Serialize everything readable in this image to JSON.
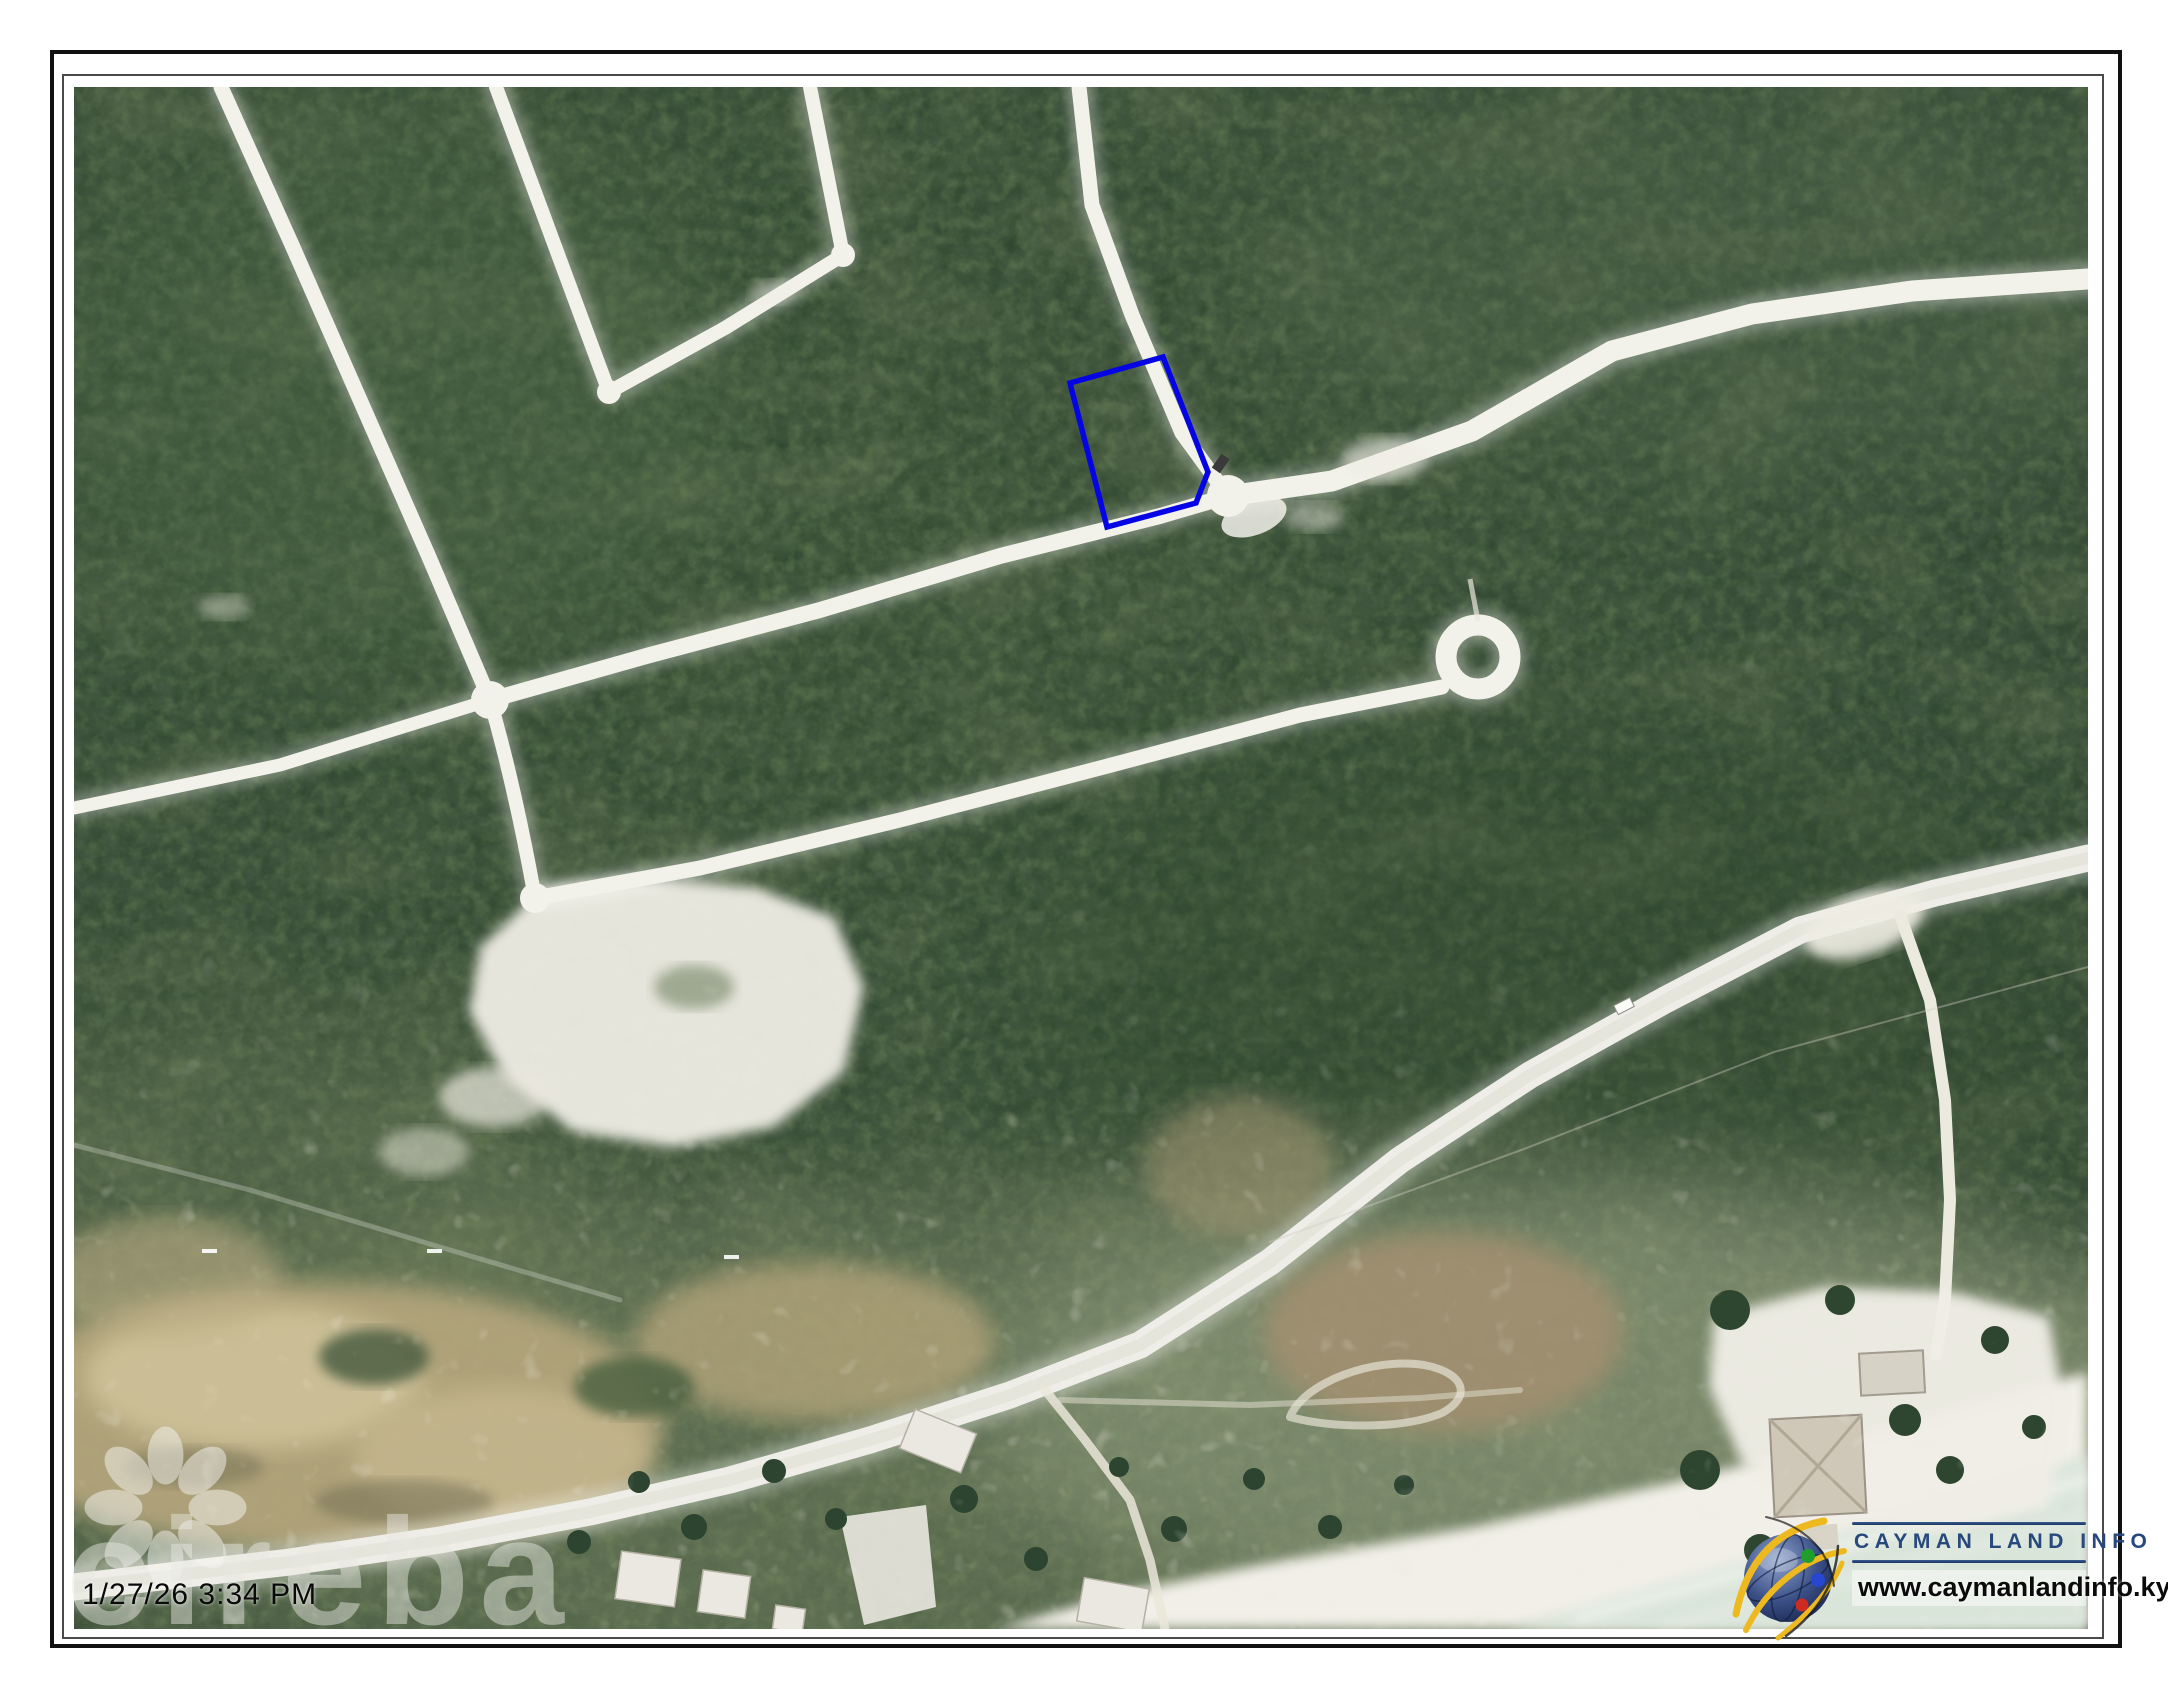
{
  "map": {
    "type": "aerial-photo",
    "description": "Satellite aerial view of a coastal subdivision with unpaved white roads through dense green vegetation, a cul-de-sac, a sand clearing, mud flats, a coastal highway, beach and ocean at lower right",
    "timestamp": "1/27/26 3:34 PM",
    "parcel": {
      "highlighted": true,
      "outline_color": "#0404e4"
    },
    "features": [
      "subdivision-roads",
      "u-shaped-block-road",
      "four-way-intersection",
      "cul-de-sac",
      "highlighted-parcel",
      "main-road",
      "sand-clearing",
      "mud-flats",
      "coastal-highway",
      "beach",
      "ocean",
      "beach-houses"
    ]
  },
  "watermark": {
    "brand": "cireba",
    "icon": "flower-petal-icon",
    "color": "rgba(232,232,226,0.48)"
  },
  "branding": {
    "title": "CAYMAN LAND INFO",
    "url": "www.caymanlandinfo.ky",
    "icon": "globe-swoosh-icon",
    "navy": "#26487c",
    "accent_yellow": "#edb91f",
    "dot_green": "#1f9e2c",
    "dot_blue": "#2747d0",
    "dot_red": "#ce2b20"
  },
  "colors": {
    "vegetation_dark": "#32482f",
    "vegetation_mid": "#43593f",
    "road_white": "#f2f1ea",
    "sand": "#efede4",
    "mud_tan": "#b5a67d",
    "water": "#d9e5da",
    "frame_border": "#111111"
  }
}
